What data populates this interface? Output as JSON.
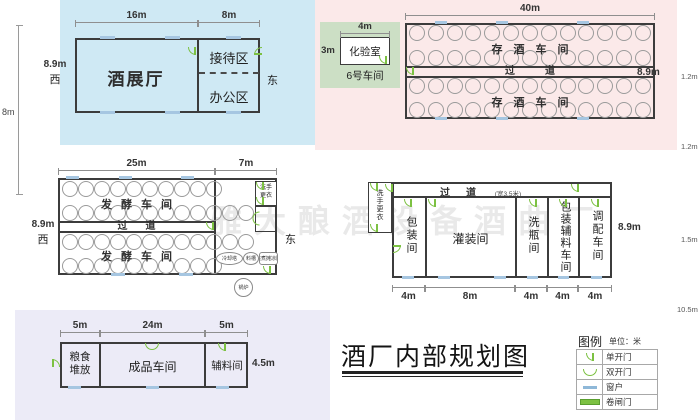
{
  "title": "酒厂内部规划图",
  "watermark": "雅大酿酒设备酒曲厂",
  "exhibition": {
    "dim_top_left": "16m",
    "dim_top_right": "8m",
    "dim_left": "8.9m",
    "west": "西",
    "east": "东",
    "dim_outer": "8m",
    "hall": "酒展厅",
    "reception": "接待区",
    "office": "办公区"
  },
  "lab": {
    "dim_top": "4m",
    "dim_left": "3m",
    "room": "化验室",
    "area": "6号车间"
  },
  "storage": {
    "dim_top": "40m",
    "dim_right": "8.9m",
    "room_top": "存酒车间",
    "corridor": "过道",
    "room_bottom": "存酒车间",
    "tanks_per_row": [
      13,
      13,
      13,
      13
    ]
  },
  "edge_dims": {
    "d1": "1.2m",
    "d2": "1.2m",
    "d3": "1.5m",
    "d4": "10.5m"
  },
  "fermentation": {
    "dim_top_left": "25m",
    "dim_top_right": "7m",
    "dim_left": "8.9m",
    "west": "西",
    "east": "东",
    "room_top": "发酵车间",
    "corridor": "过道",
    "room_bottom": "发酵车间",
    "tanks_per_row": [
      10,
      12,
      12,
      10
    ],
    "wash_line1": "洗手",
    "wash_line2": "更衣",
    "cooling": "冷却塔",
    "hopper": "料槽",
    "steaming": "蒸煮摊凉区",
    "boiler": "锅炉"
  },
  "bottling": {
    "corridor": "过道",
    "corridor_note": "(宽3.5米)",
    "wash": "洗手更衣",
    "dim_right": "8.9m",
    "rooms": [
      {
        "label": "包装间",
        "dim": "4m"
      },
      {
        "label": "灌装间",
        "dim": "8m"
      },
      {
        "label": "洗瓶间",
        "dim": "4m"
      },
      {
        "label": "包装辅料车间",
        "dim": "4m"
      },
      {
        "label": "调配车间",
        "dim": "4m"
      }
    ]
  },
  "finished": {
    "dim_1": "5m",
    "dim_2": "24m",
    "dim_3": "5m",
    "dim_right": "4.5m",
    "grain_line1": "粮食",
    "grain_line2": "堆放",
    "product": "成品车间",
    "aux": "辅料间"
  },
  "legend": {
    "title": "图例",
    "unit": "单位：米",
    "items": [
      {
        "label": "单开门"
      },
      {
        "label": "双开门"
      },
      {
        "label": "窗户"
      },
      {
        "label": "卷闸门"
      }
    ]
  },
  "colors": {
    "door": "#7cc142",
    "window": "#a6c6e1",
    "wall": "#3c3c3c",
    "bg_blue": "#cfe9f4",
    "bg_pink": "#fbe9e9",
    "bg_green": "#ccdfc5",
    "bg_purple": "#ecebf7"
  }
}
